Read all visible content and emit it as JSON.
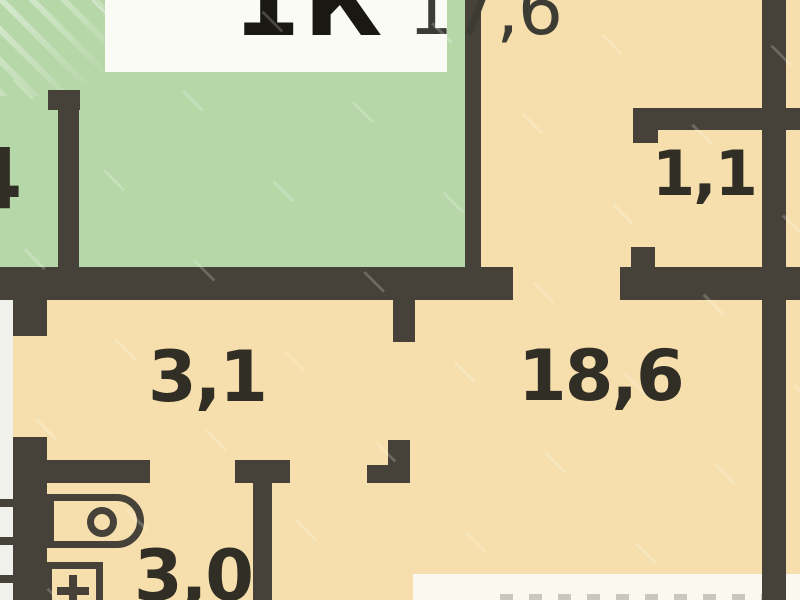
{
  "plan": {
    "type": "apartment-floor-plan",
    "title": {
      "unit": "1К",
      "area": "17,6"
    },
    "rooms": [
      {
        "name": "neighbor-room-partial",
        "label": "4"
      },
      {
        "name": "storage-closet",
        "label": "1,1"
      },
      {
        "name": "hallway",
        "label": "3,1"
      },
      {
        "name": "main-room",
        "label": "18,6"
      },
      {
        "name": "bathroom",
        "label": "3,0"
      }
    ],
    "fixtures": [
      {
        "name": "toilet"
      },
      {
        "name": "washbasin"
      }
    ],
    "colors": {
      "wall": "#46423a",
      "green_room": "#b6d7a8",
      "beige_room": "#f6dfac",
      "label_box": "#fbfbf6",
      "text": "#312e26",
      "outside": "#f1f1ec"
    }
  }
}
